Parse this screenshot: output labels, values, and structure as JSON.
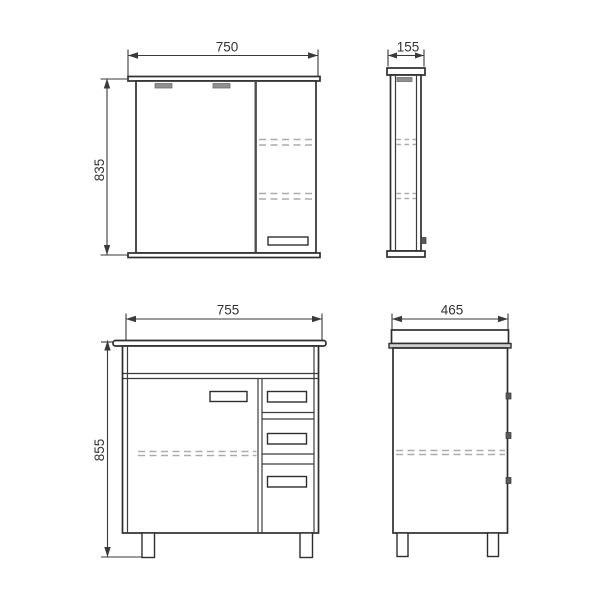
{
  "drawing": {
    "views": {
      "mirror_front": {
        "width": "750",
        "height": "835"
      },
      "mirror_side": {
        "depth": "155"
      },
      "vanity_front": {
        "width": "755",
        "height": "855"
      },
      "vanity_side": {
        "depth": "465"
      }
    },
    "colors": {
      "background": "#ffffff",
      "outline": "#2e2e2e",
      "dimension": "#3a3a3a",
      "hidden_dash": "#ababab",
      "lamp_gray": "#909090",
      "knob_dark": "#5a5a5a"
    }
  }
}
